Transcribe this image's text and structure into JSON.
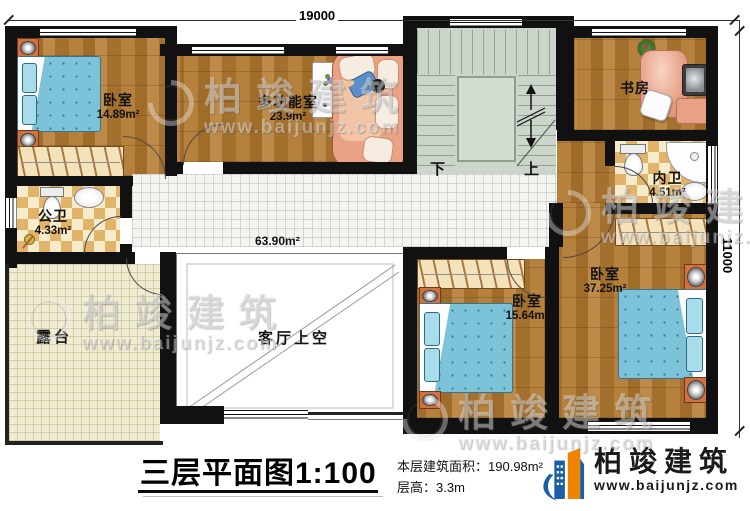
{
  "dimensions": {
    "top": "19000",
    "right": "11000"
  },
  "rooms": {
    "bedroom1": {
      "name": "卧室",
      "area": "14.89m²"
    },
    "multi": {
      "name": "多功能室",
      "area": "23.9m²"
    },
    "study": {
      "name": "书房"
    },
    "inner_bath": {
      "name": "内卫",
      "area": "4.51m²"
    },
    "public_bath": {
      "name": "公卫",
      "area": "4.33m²"
    },
    "terrace": {
      "name": "露台"
    },
    "void": {
      "name": "客厅上空"
    },
    "hall": {
      "area": "63.90m²"
    },
    "bedroom2": {
      "name": "卧室",
      "area": "15.64m²"
    },
    "bedroom3": {
      "name": "卧室",
      "area": "37.25m²"
    }
  },
  "stairs": {
    "down": "下",
    "up": "上"
  },
  "title": {
    "name": "三层平面图",
    "scale": "1:100"
  },
  "info": {
    "area_label": "本层建筑面积：",
    "area_value": "190.98m²",
    "height_label": "层高：",
    "height_value": "3.3m"
  },
  "brand": {
    "name": "柏竣建筑",
    "url": "www.baijunjz.com"
  },
  "watermark": {
    "name": "柏竣建筑",
    "url": "www.baijunjz.com"
  },
  "colors": {
    "wall": "#111111",
    "wood": "#a9752f",
    "brand_blue": "#1b5ea6",
    "brand_orange": "#f08300"
  }
}
